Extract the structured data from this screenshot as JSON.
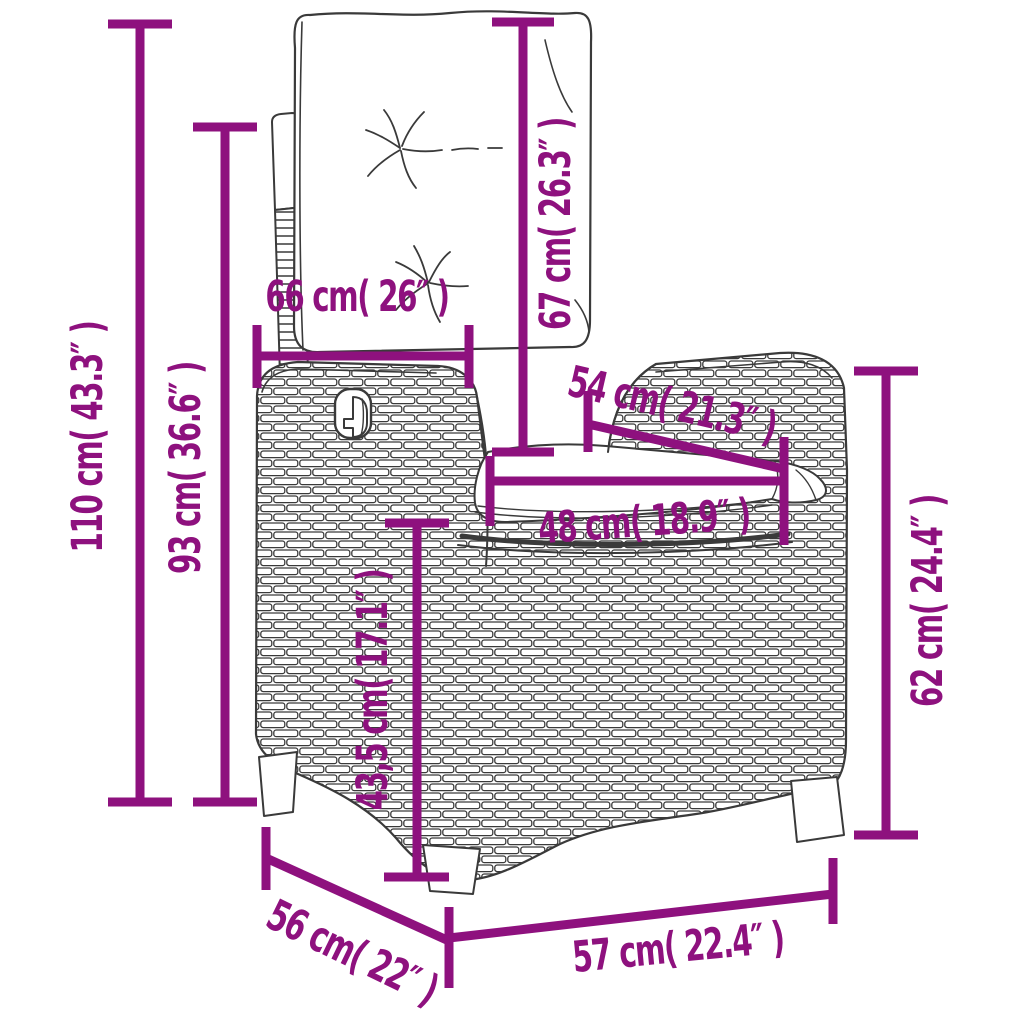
{
  "figure": {
    "type": "product-dimension-diagram",
    "background": "#ffffff",
    "accent_color": "#8e117e",
    "line_art_color": "#3a3a3a",
    "unit_pattern": "cm ( inches )",
    "dimensions": [
      {
        "id": "total-height",
        "label": "110 cm( 43.3″ )",
        "cm": "110",
        "inches": "43.3",
        "orientation": "vertical"
      },
      {
        "id": "backrest-height",
        "label": "93 cm( 36.6″ )",
        "cm": "93",
        "inches": "36.6",
        "orientation": "vertical"
      },
      {
        "id": "backrest-width",
        "label": "66 cm( 26″ )",
        "cm": "66",
        "inches": "26",
        "orientation": "horizontal"
      },
      {
        "id": "back-cushion-height",
        "label": "67 cm( 26.3″ )",
        "cm": "67",
        "inches": "26.3",
        "orientation": "vertical"
      },
      {
        "id": "seat-depth",
        "label": "54 cm( 21.3″ )",
        "cm": "54",
        "inches": "21.3",
        "orientation": "diagonal"
      },
      {
        "id": "seat-width",
        "label": "48 cm( 18.9″ )",
        "cm": "48",
        "inches": "18.9",
        "orientation": "horizontal"
      },
      {
        "id": "seat-height",
        "label": "43,5 cm( 17.1″ )",
        "cm": "43,5",
        "inches": "17.1",
        "orientation": "vertical"
      },
      {
        "id": "armrest-height",
        "label": "62 cm( 24.4″ )",
        "cm": "62",
        "inches": "24.4",
        "orientation": "vertical"
      },
      {
        "id": "base-depth",
        "label": "56 cm( 22″ )",
        "cm": "56",
        "inches": "22",
        "orientation": "diagonal"
      },
      {
        "id": "base-width",
        "label": "57 cm( 22.4″ )",
        "cm": "57",
        "inches": "22.4",
        "orientation": "horizontal"
      }
    ]
  }
}
